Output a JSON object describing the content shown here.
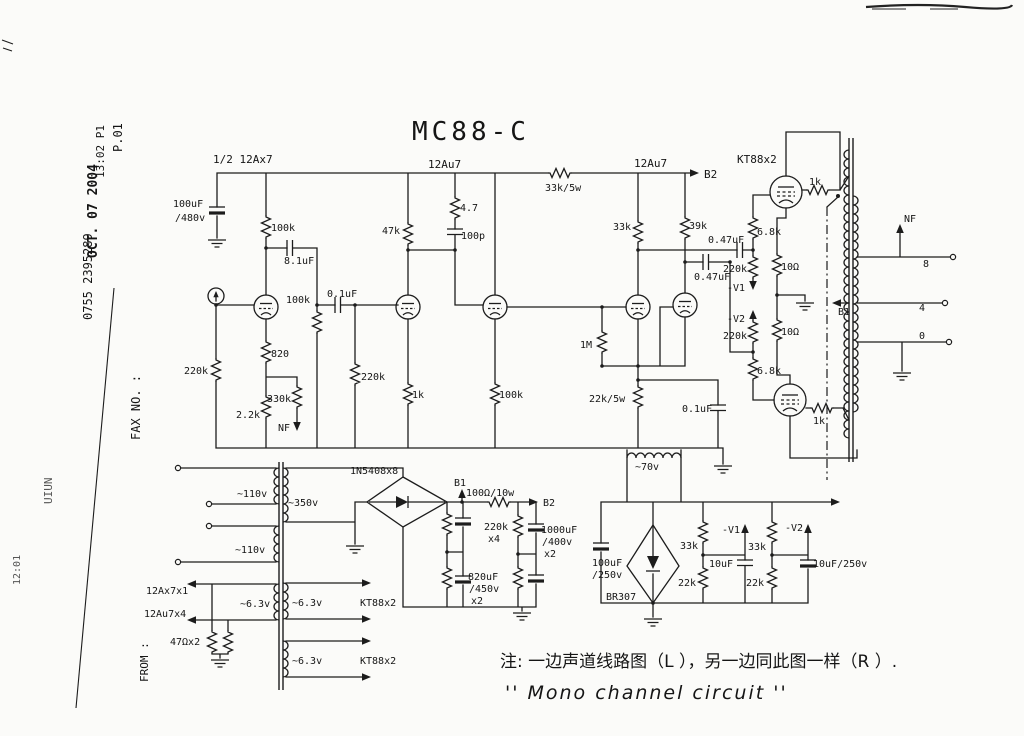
{
  "title": "MC88-C",
  "fax": {
    "page": "P.01",
    "date": "OCT. 07 2004",
    "time_page": "13:02   P1",
    "number": "0755  2395289",
    "fax_no": "FAX NO. :",
    "from": "FROM :",
    "corner_note": "UIUN",
    "fragment": "12:01"
  },
  "notes": {
    "cn": "注: 一边声道线路图（L ），另一边同此图一样（R ）.",
    "en": "'' Mono channel circuit ''"
  },
  "labels": {
    "tube1": "1/2 12Ax7",
    "tube2": "12Au7",
    "tube45": "12Au7",
    "kt88": "KT88x2",
    "b2_top": "B2",
    "c_input_f": "100uF",
    "c_input_fv": "/480v",
    "r_plate1": "100k",
    "c_comp": "8.1uF",
    "r_fb": "100k",
    "c_couple1": "0.1uF",
    "r_in": "220k",
    "r_cath1": "820",
    "r_nfb": "330k",
    "nfb": "NF",
    "r_cath1b": "2.2k",
    "r_grid2": "220k",
    "r_plate2": "47k",
    "r_comp": "4.7",
    "c_comp2": "100p",
    "r_cath2": "1k",
    "r_cath3": "100k",
    "r_rail": "33k/5w",
    "r_grid_pi": "1M",
    "r_tail": "22k/5w",
    "c_decouple": "0.1uF",
    "r_plate_pi1": "33k",
    "r_plate_pi2": "39k",
    "c_couple_u": "0.47uF",
    "c_couple_l": "0.47uF",
    "r_gu": "6.8k",
    "r_gl": "6.8k",
    "r_glu": "220k",
    "r_gll": "220k",
    "v1": "-V1",
    "v2": "-V2",
    "r_ku": "10Ω",
    "r_kl": "10Ω",
    "r_stop_u": "1k",
    "r_stop_l": "1k",
    "nf_right": "NF",
    "tap8": "8",
    "tap4": "4",
    "tap0": "0",
    "b1_ot": "B1",
    "mains1": "~110v",
    "mains2": "~110v",
    "hv_sec": "~350v",
    "bridge1": "1N5408x8",
    "b1_ps": "B1",
    "r_filter": "100Ω/10w",
    "b2_ps": "B2",
    "r_bleed": "220k",
    "r_bleed_x": "x4",
    "c_f2": "1000uF",
    "c_f2v": "/400v",
    "c_f2x": "x2",
    "c_f1": "820uF",
    "c_f1v": "/450v",
    "c_f1x": "x2",
    "bias_w": "~70v",
    "c_bias": "100uF",
    "c_biasv": "/250v",
    "br307": "BR307",
    "r_b1a": "33k",
    "r_b1b": "22k",
    "v1_b": "-V1",
    "c_b1": "10uF",
    "r_b2a": "33k",
    "r_b2b": "22k",
    "v2_b": "-V2",
    "c_b2": "10uF/250v",
    "h_t1": "12Ax7x1",
    "h_t2": "12Au7x4",
    "h_hum": "47Ωx2",
    "h63_l": "~6.3v",
    "h63_r1": "~6.3v",
    "h63_r2": "~6.3v",
    "h_kt1": "KT88x2",
    "h_kt2": "KT88x2"
  }
}
